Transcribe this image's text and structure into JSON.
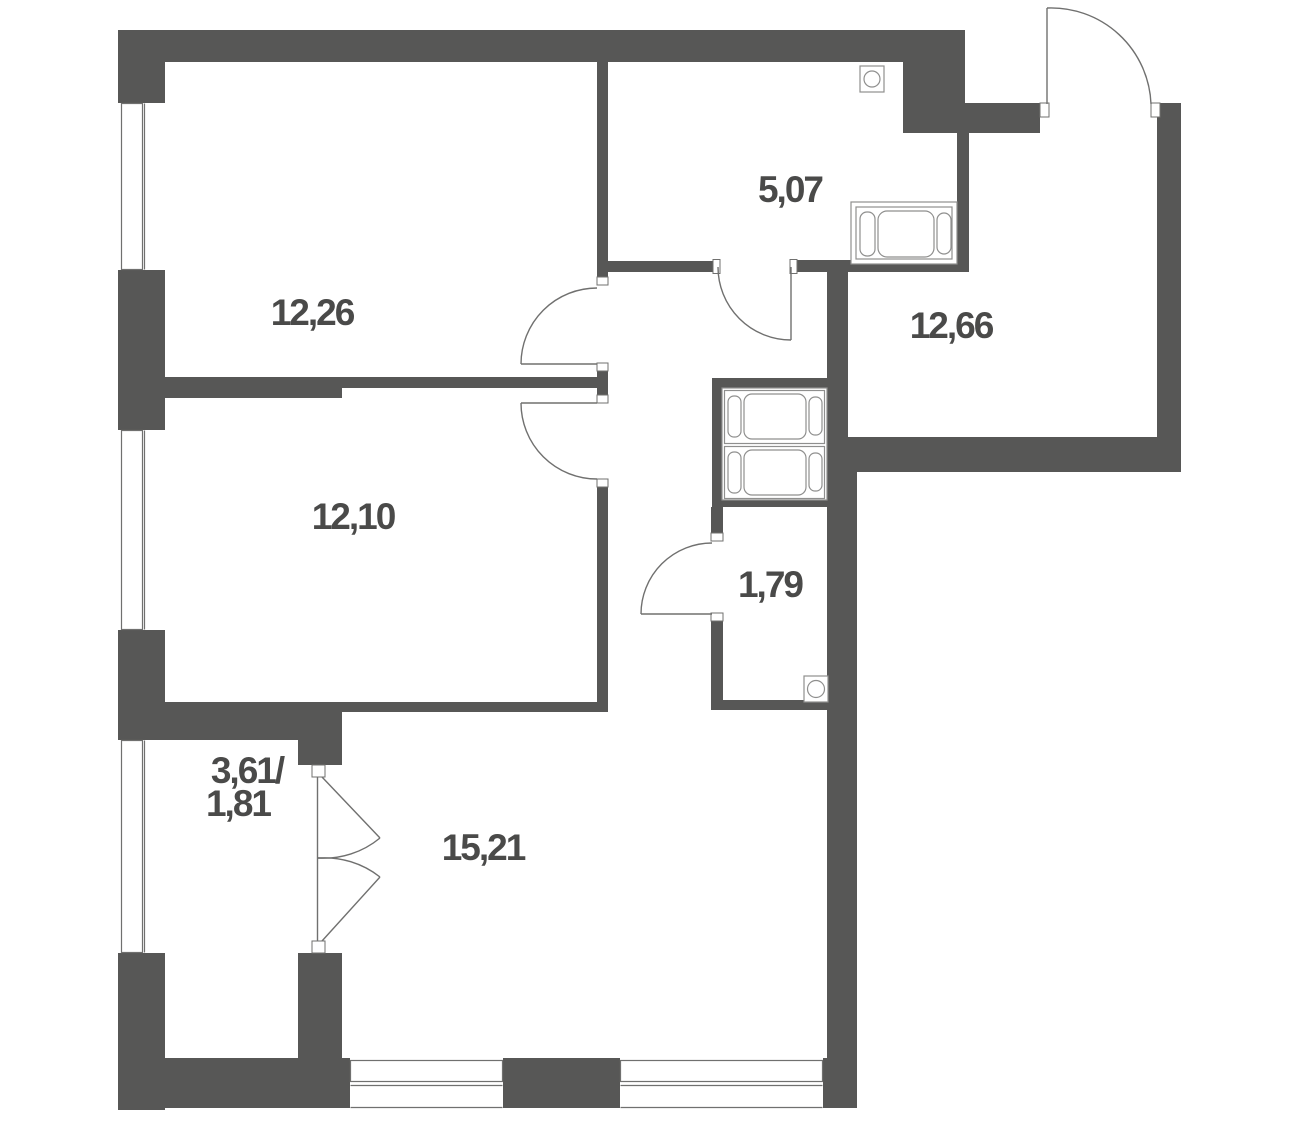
{
  "plan": {
    "title": "apartment-floor-plan",
    "background": "#ffffff",
    "wall_color": "#575756",
    "line_color": "#70706f",
    "fixture_color": "#8f8f8e",
    "text_color": "#4a4a49",
    "rooms": [
      {
        "name": "room-top-left",
        "area": "12,26"
      },
      {
        "name": "bathroom",
        "area": "5,07"
      },
      {
        "name": "hallway",
        "area": "12,66"
      },
      {
        "name": "room-middle-left",
        "area": "12,10"
      },
      {
        "name": "wc",
        "area": "1,79"
      },
      {
        "name": "living-room",
        "area": "15,21"
      },
      {
        "name": "balcony",
        "area": "3,61/",
        "area2": "1,81"
      }
    ]
  }
}
